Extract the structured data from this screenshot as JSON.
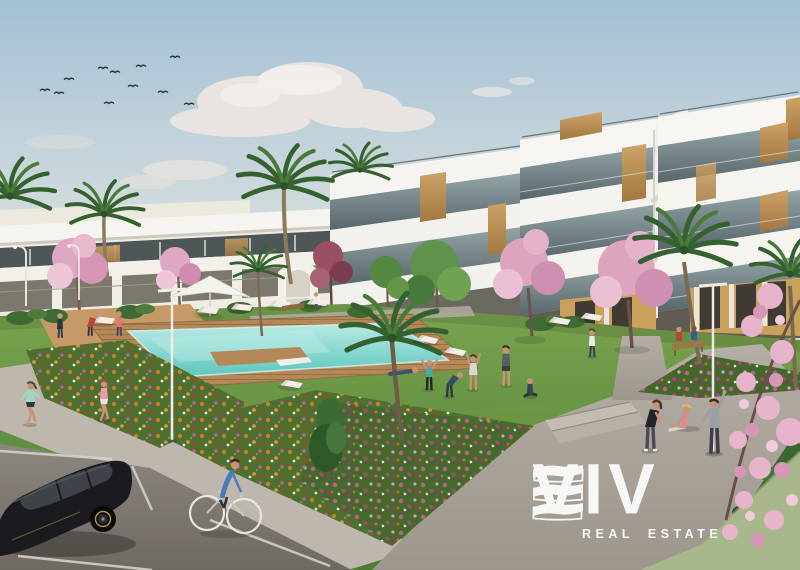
{
  "watermark": {
    "brand_text": "VIV",
    "brand_mark": "wave-e-icon",
    "brand_mark_outline": "outline-e-icon",
    "tagline": "REAL ESTATE",
    "color": "#ffffff"
  },
  "scene": {
    "elements": [
      "sky",
      "clouds",
      "bird-flock",
      "apartment-building-right",
      "apartment-row-left",
      "palm-trees",
      "cherry-blossom-trees",
      "green-trees",
      "lawn",
      "swimming-pool",
      "pool-deck",
      "sun-loungers",
      "parasol",
      "park-benches",
      "street-lamps",
      "flower-beds",
      "footpath",
      "plaza-steps",
      "road",
      "parking-lines",
      "parked-car",
      "cyclist",
      "joggers",
      "people-exercising",
      "hedge"
    ],
    "colors": {
      "sky_top": "#a3c0d5",
      "sky_horizon": "#e7e3d9",
      "cloud": "#ece6e2",
      "building_white": "#f6f4ef",
      "glass": "#5d6d70",
      "wood_accent": "#c49a5e",
      "palm_green": "#35602f",
      "lawn": "#5e8c3d",
      "pool_water": "#5cc6bd",
      "pool_shallow": "#b9ebe4",
      "deck_wood": "#b5885a",
      "flower_orange": "#d07c2c",
      "flower_magenta": "#bd5d97",
      "blossom_pink": "#e3aec8",
      "path_gray": "#aca69d",
      "road_gray": "#7e7971",
      "car_black": "#1b1b1f",
      "watermark": "#ffffff"
    }
  }
}
